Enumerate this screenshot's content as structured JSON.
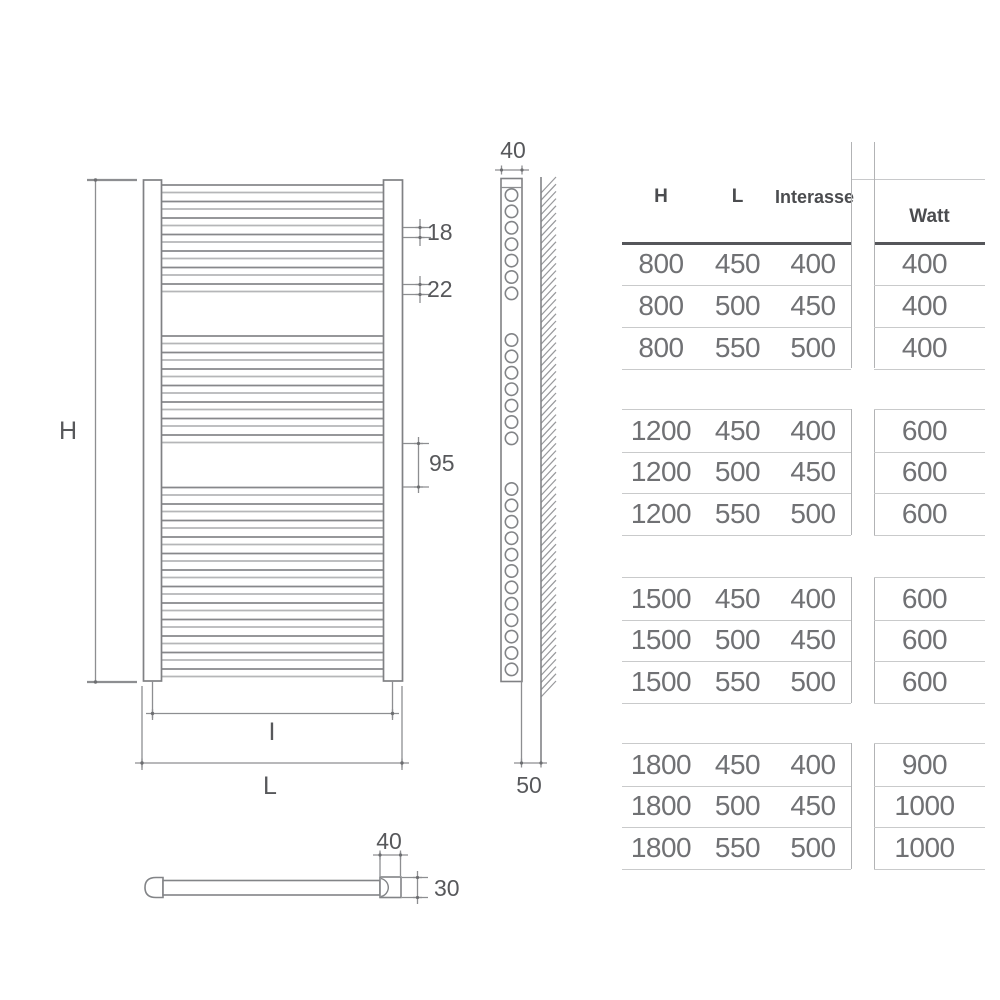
{
  "diagram": {
    "front_view": {
      "label_height": "H",
      "label_interaxis": "I",
      "label_width": "L",
      "dim_tube": "18",
      "dim_tube_gap": "22",
      "dim_section_gap": "95",
      "rung_groups": [
        7,
        7,
        12
      ]
    },
    "side_view": {
      "dim_depth": "40",
      "dim_bottom": "50",
      "hole_groups": [
        7,
        7,
        12
      ]
    },
    "top_view": {
      "dim_collector_width": "40",
      "dim_collector_depth": "30"
    }
  },
  "table": {
    "headers": {
      "h": "H",
      "l": "L",
      "interasse": "Interasse",
      "watt": "Watt"
    },
    "groups": [
      {
        "rows": [
          [
            "800",
            "450",
            "400",
            "400"
          ],
          [
            "800",
            "500",
            "450",
            "400"
          ],
          [
            "800",
            "550",
            "500",
            "400"
          ]
        ]
      },
      {
        "rows": [
          [
            "1200",
            "450",
            "400",
            "600"
          ],
          [
            "1200",
            "500",
            "450",
            "600"
          ],
          [
            "1200",
            "550",
            "500",
            "600"
          ]
        ]
      },
      {
        "rows": [
          [
            "1500",
            "450",
            "400",
            "600"
          ],
          [
            "1500",
            "500",
            "450",
            "600"
          ],
          [
            "1500",
            "550",
            "500",
            "600"
          ]
        ]
      },
      {
        "rows": [
          [
            "1800",
            "450",
            "400",
            "900"
          ],
          [
            "1800",
            "500",
            "450",
            "1000"
          ],
          [
            "1800",
            "550",
            "500",
            "1000"
          ]
        ]
      }
    ]
  }
}
